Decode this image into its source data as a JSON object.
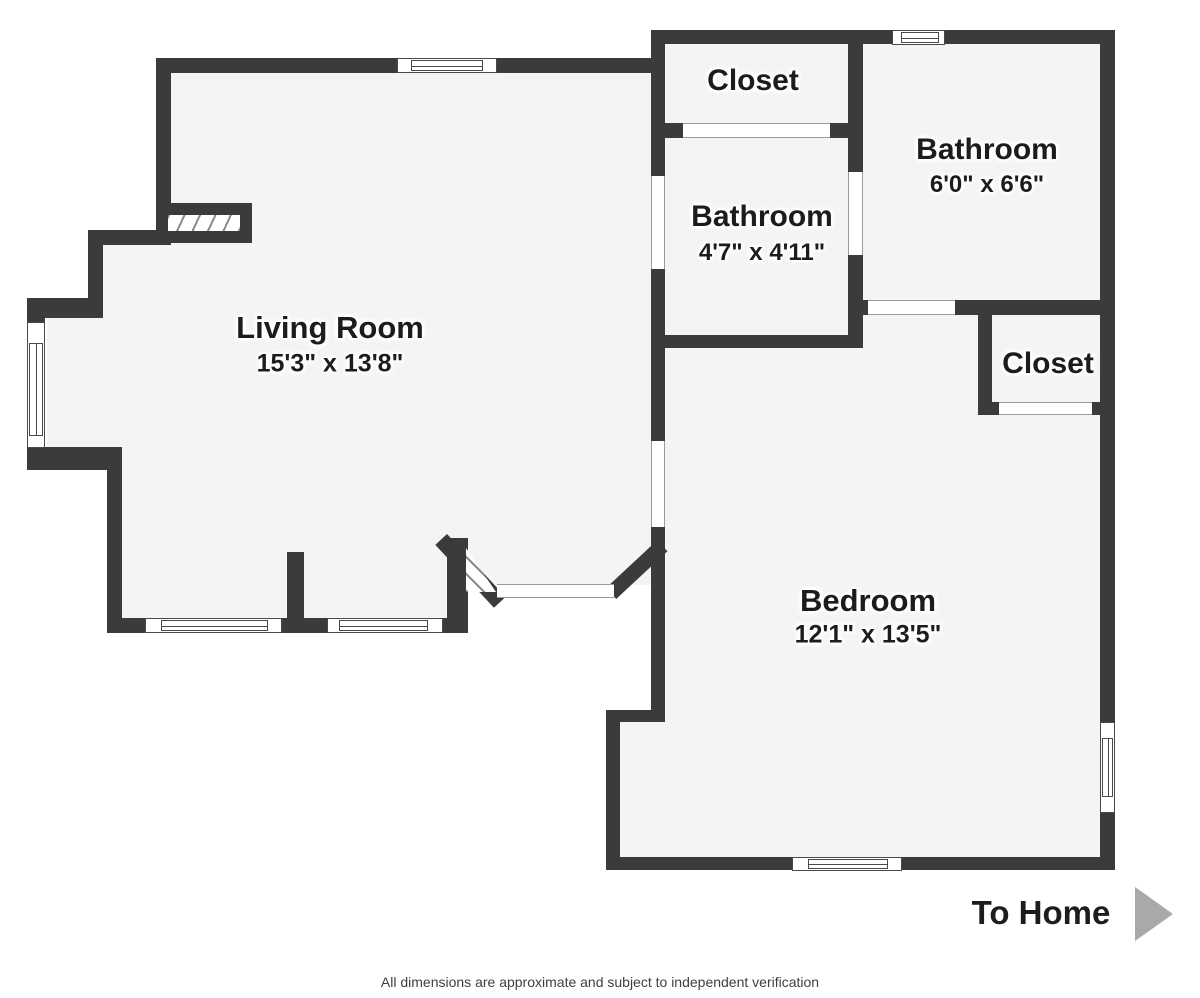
{
  "rooms": {
    "living_room": {
      "label": "Living Room",
      "dimensions": "15'3\" x 13'8\""
    },
    "closet_top": {
      "label": "Closet"
    },
    "bathroom_middle": {
      "label": "Bathroom",
      "dimensions": "4'7\" x 4'11\""
    },
    "bathroom_top_right": {
      "label": "Bathroom",
      "dimensions": "6'0\" x 6'6\""
    },
    "closet_right": {
      "label": "Closet"
    },
    "bedroom": {
      "label": "Bedroom",
      "dimensions": "12'1\" x 13'5\""
    }
  },
  "annotations": {
    "to_home": "To Home",
    "footer_note": "All dimensions are approximate and subject to independent verification"
  },
  "palette": {
    "wall": "#3b3b3b",
    "floor": "#f4f4f4",
    "arrow": "#a9a9a9",
    "label_text": "#1c1c1c"
  }
}
